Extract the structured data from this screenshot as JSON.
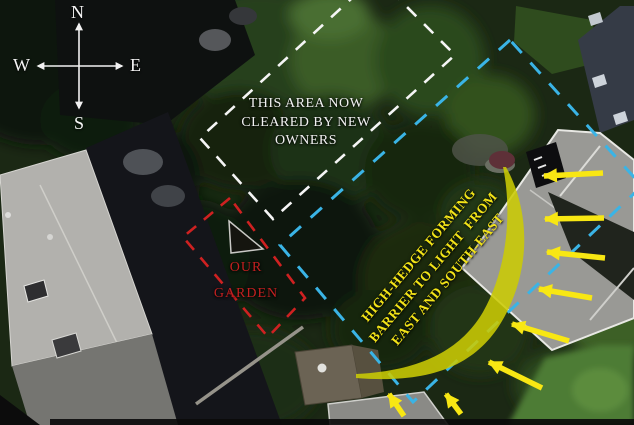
{
  "compass": {
    "north": "N",
    "south": "S",
    "east": "E",
    "west": "W"
  },
  "labels": {
    "cleared_area": {
      "lines": [
        "THIS AREA NOW",
        "CLEARED BY NEW",
        "OWNERS"
      ],
      "color": "#f2f2f2"
    },
    "our_garden": {
      "lines": [
        "OUR",
        "GARDEN"
      ],
      "color": "#c32020"
    },
    "hedge": {
      "lines": [
        "HIGH-HEDGE FORMING",
        "BARRIER TO LIGHT  FROM",
        "EAST AND SOUTH-EAST"
      ],
      "color": "#f2e318"
    }
  },
  "annotations": {
    "cleared_area_outline_color": "#f5f5f5",
    "boundary_outline_color": "#3ab4e6",
    "our_garden_outline_color": "#cf2121",
    "hedge_fill_color": "#cbcb04",
    "arrow_color": "#f8e713",
    "compass_color": "#f2f2f2"
  }
}
